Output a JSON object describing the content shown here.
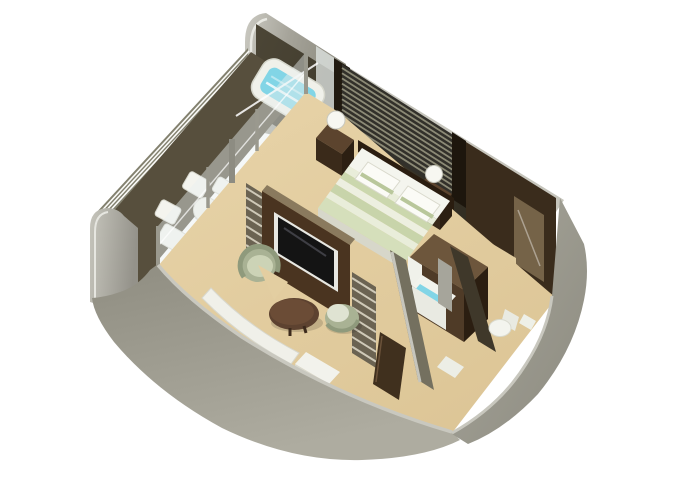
{
  "scene": {
    "type": "isometric-3d-floorplan",
    "subject": "suite floor plan with private veranda",
    "background": "#ffffff",
    "rooms": [
      "veranda",
      "bedroom",
      "living-area",
      "walk-in-closet",
      "bathroom",
      "entry-corridor"
    ],
    "furniture": [
      "whirlpool-tub",
      "veranda-chairs",
      "veranda-table",
      "bed",
      "nightstands",
      "table-lamps",
      "media-wall-tv",
      "armchair",
      "round-chair",
      "coffee-table",
      "wardrobe",
      "vanity",
      "toilet",
      "entry-door"
    ]
  },
  "palette": {
    "floor": "#e3cea1",
    "verandaFloor": "#574f3d",
    "hullLight": "#c7c6bd",
    "hullMid": "#a09e93",
    "railing": "#83816f",
    "wallDark": "#3e382c",
    "wallOlive": "#74705f",
    "slatLight": "#8c8a76",
    "woodDark": "#3a2a1a",
    "woodMid": "#5c442e",
    "woodDeep": "#2b1e11",
    "mediaWood": "#4a3420",
    "closetWood": "#3a2c1c",
    "bedWhite": "#f4f5ee",
    "bedStripe": "#cbd7ad",
    "sage": "#a9b294",
    "sageLight": "#ccd3b6",
    "tableBrown": "#5d4230",
    "white": "#f2f2ec",
    "tv": "#141414",
    "water": "#82d5e6",
    "glass": "#e8efef"
  }
}
